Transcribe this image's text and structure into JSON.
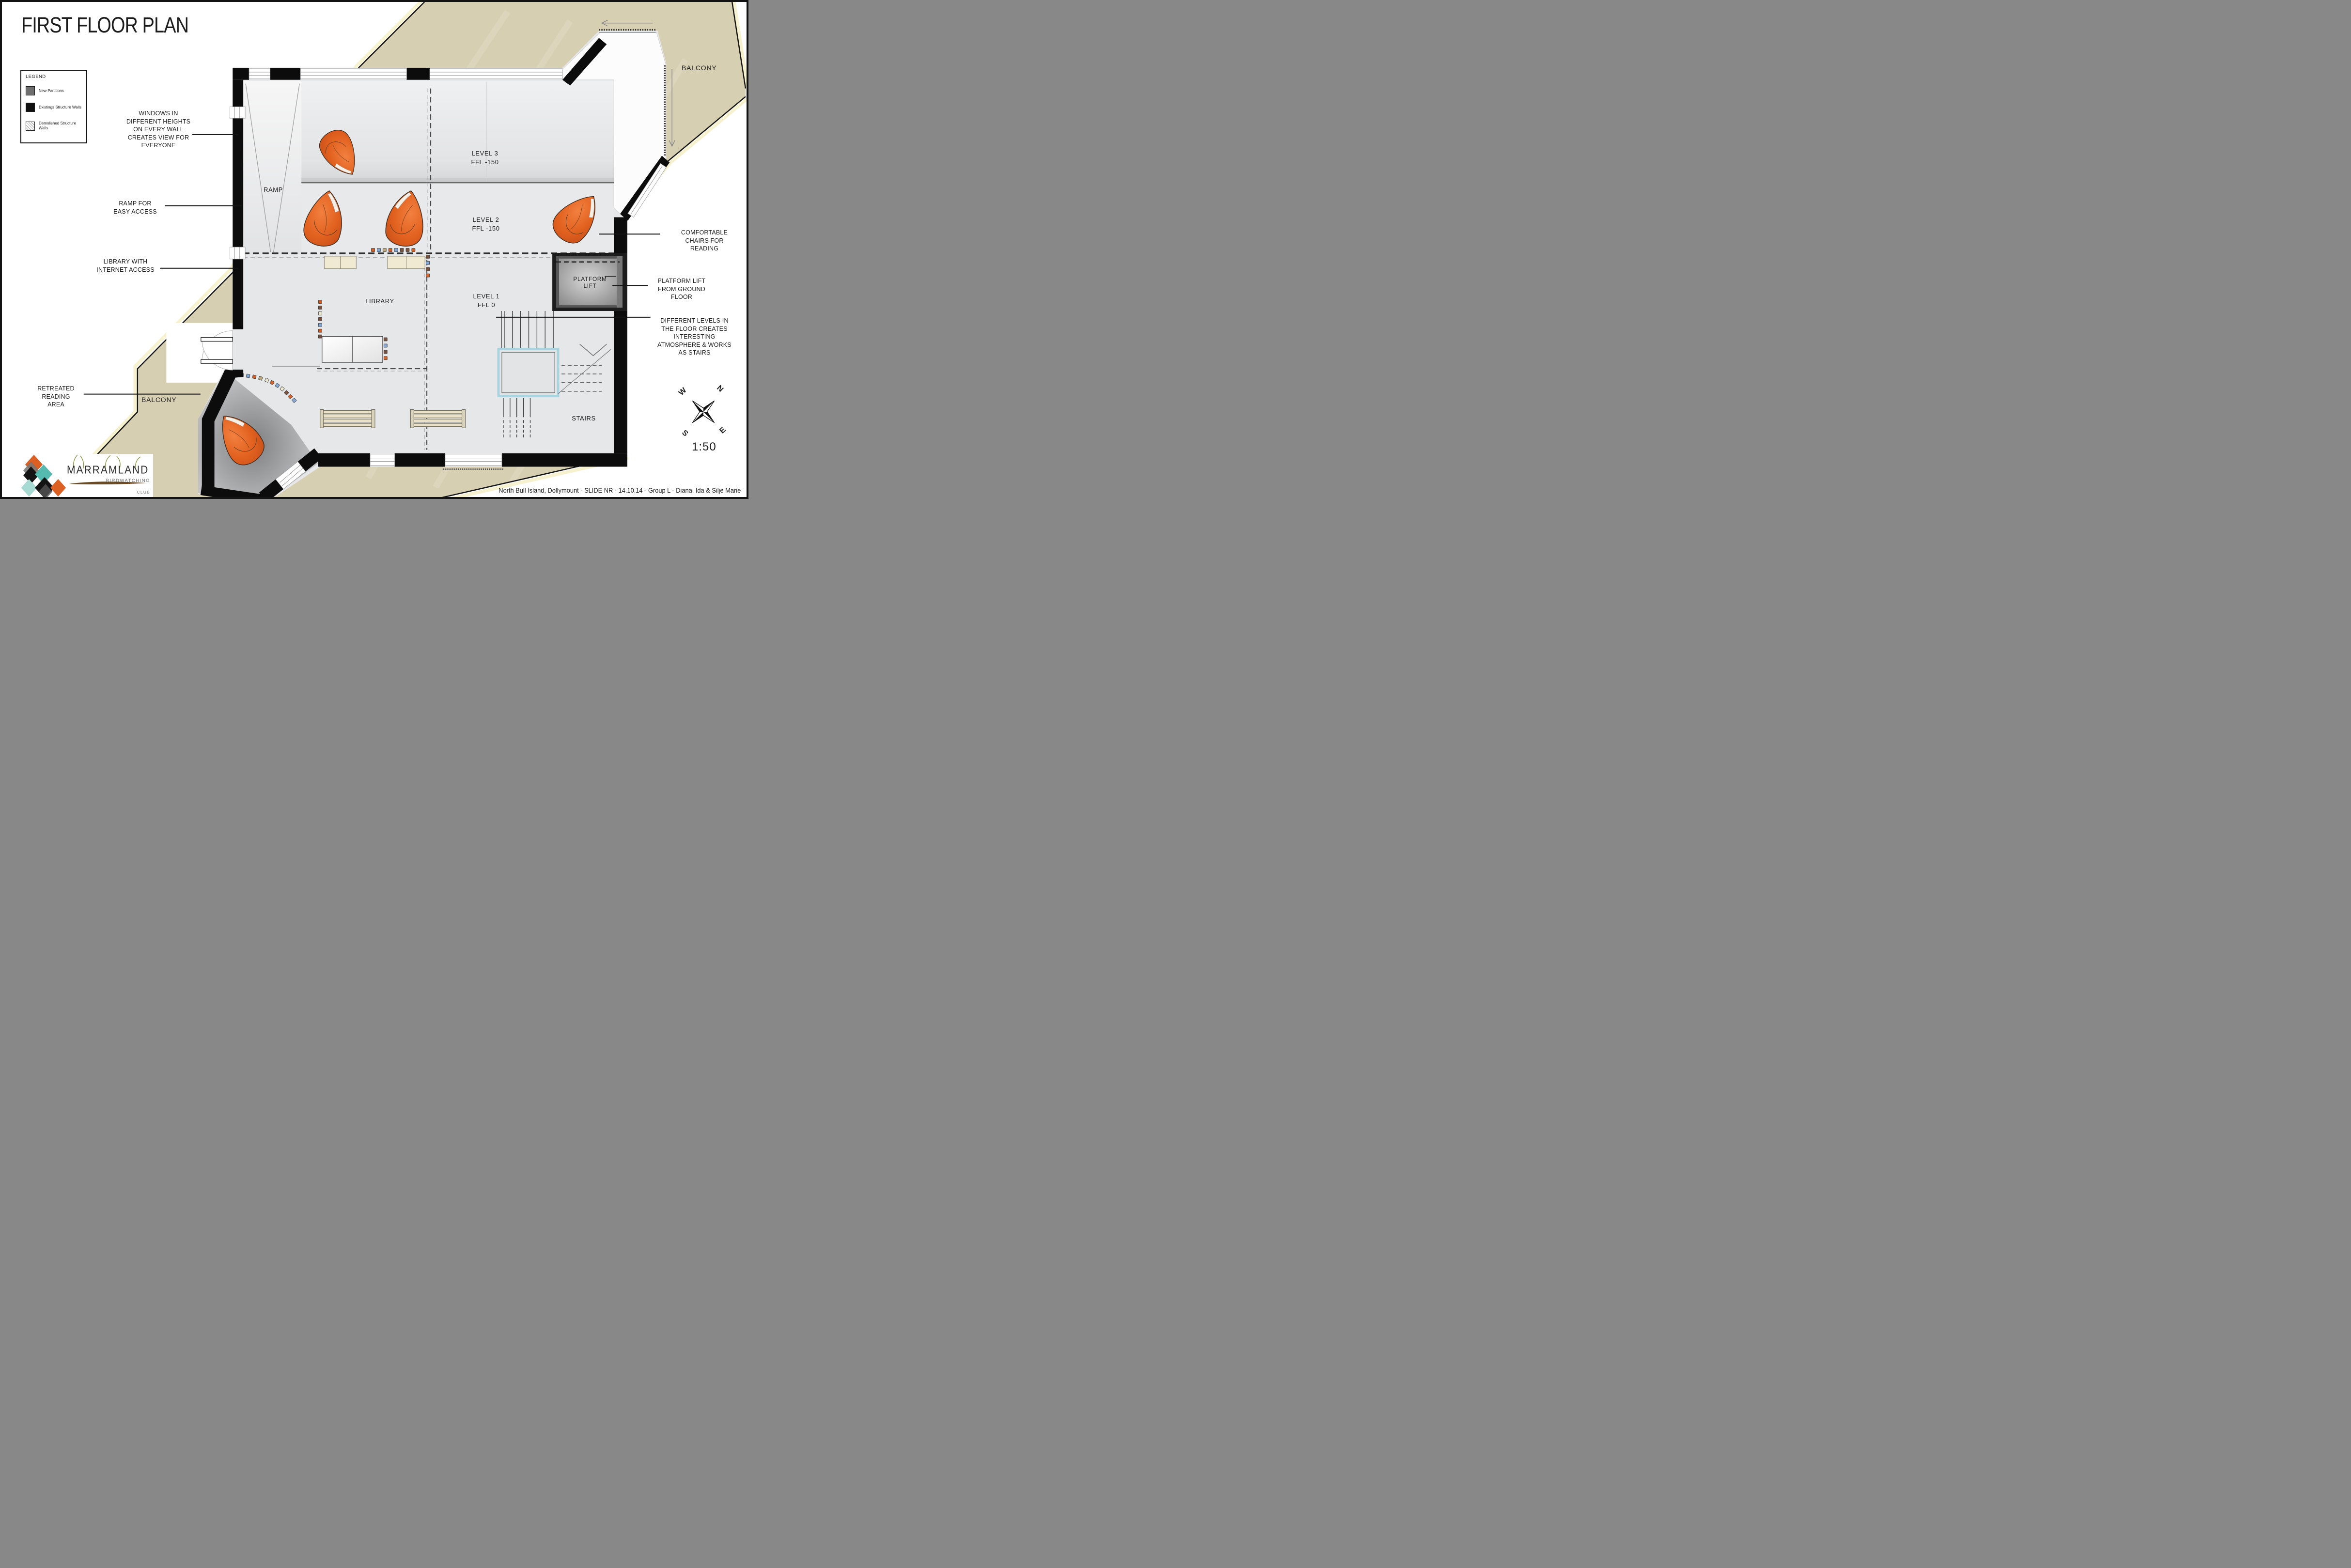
{
  "title": "FIRST FLOOR PLAN",
  "legend": {
    "heading": "LEGEND",
    "items": [
      {
        "label": "New Partitions",
        "swatch": "new-partitions"
      },
      {
        "label": "Existings Structure Walls",
        "swatch": "existing-structure-walls"
      },
      {
        "label": "Demolished Structure Walls",
        "swatch": "demolished-structure-walls"
      }
    ]
  },
  "annotations": {
    "windows": "WINDOWS IN DIFFERENT HEIGHTS ON EVERY WALL CREATES VIEW FOR EVERYONE",
    "ramp": "RAMP FOR EASY ACCESS",
    "library": "LIBRARY WITH INTERNET ACCESS",
    "retreated": "RETREATED READING AREA",
    "chairs": "COMFORTABLE CHAIRS FOR READING",
    "lift": "PLATFORM LIFT FROM GROUND FLOOR",
    "levels": "DIFFERENT LEVELS IN THE FLOOR CREATES INTERESTING ATMOSPHERE & WORKS AS STAIRS"
  },
  "rooms": {
    "ramp": "RAMP",
    "level3": {
      "name": "LEVEL 3",
      "ffl": "FFL -150"
    },
    "level2": {
      "name": "LEVEL 2",
      "ffl": "FFL -150"
    },
    "level1": {
      "name": "LEVEL 1",
      "ffl": "FFL 0"
    },
    "library": "LIBRARY",
    "platform_lift": "PLATFORM LIFT",
    "stairs": "STAIRS",
    "balcony_upper": "BALCONY",
    "balcony_lower": "BALCONY"
  },
  "compass": {
    "n": "N",
    "e": "E",
    "s": "S",
    "w": "W"
  },
  "scale_label": "1:50",
  "footer": "North Bull Island, Dollymount - SLIDE NR -  14.10.14 - Group L - Diana, Ida & Silje Marie",
  "logo": {
    "name": "MARRAMLAND",
    "subtitle": "BIRDWATCHING",
    "club": "CLUB"
  },
  "colors": {
    "balcony_beige": "#D7CFB2",
    "edge_cream": "#F6F1CF",
    "wall_black": "#0C0C0C",
    "floor_gray": "#E6E7E9",
    "chair_orange": "#E2611F",
    "stair_glass": "#A8D4E0",
    "logo_orange": "#DD6023",
    "logo_teal": "#55BBB0"
  }
}
